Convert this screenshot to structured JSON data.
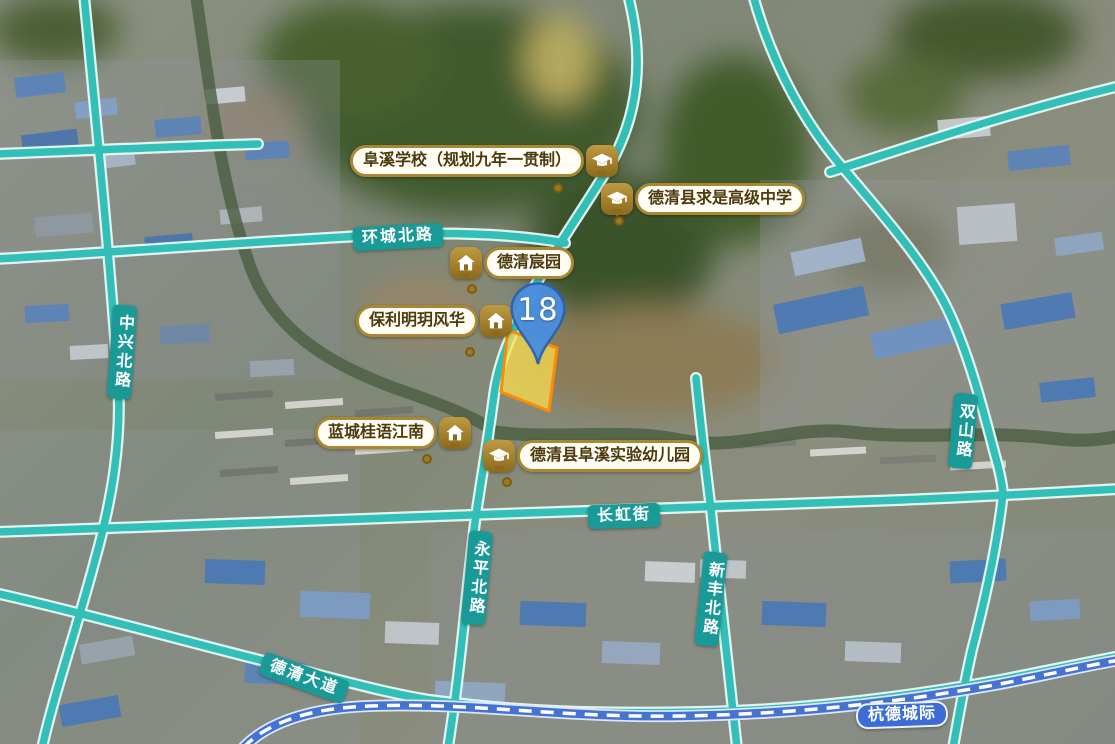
{
  "map": {
    "plot_marker": {
      "number": "18"
    },
    "poi_labels": [
      {
        "id": "fuxi-school",
        "text": "阜溪学校（规划九年一贯制）",
        "icon": "school-icon",
        "icon_side": "right"
      },
      {
        "id": "qiushi-high-school",
        "text": "德清县求是高级中学",
        "icon": "school-icon",
        "icon_side": "left"
      },
      {
        "id": "deqing-chenyuan",
        "text": "德清宸园",
        "icon": "house-icon",
        "icon_side": "left"
      },
      {
        "id": "poly-mingyue",
        "text": "保利明玥风华",
        "icon": "house-icon",
        "icon_side": "right"
      },
      {
        "id": "lancheng-guiyu",
        "text": "蓝城桂语江南",
        "icon": "house-icon",
        "icon_side": "right"
      },
      {
        "id": "fuxi-kindergarten",
        "text": "德清县阜溪实验幼儿园",
        "icon": "school-icon",
        "icon_side": "left"
      }
    ],
    "road_labels": [
      {
        "id": "huancheng-north-rd",
        "text": "环城北路",
        "orientation": "horizontal"
      },
      {
        "id": "zhongxing-north-rd",
        "text": "中兴北路",
        "orientation": "vertical"
      },
      {
        "id": "changhong-street",
        "text": "长虹街",
        "orientation": "horizontal"
      },
      {
        "id": "yongping-north-rd",
        "text": "永平北路",
        "orientation": "vertical"
      },
      {
        "id": "xinfeng-north-rd",
        "text": "新丰北路",
        "orientation": "vertical"
      },
      {
        "id": "shuangshan-rd",
        "text": "双山路",
        "orientation": "vertical"
      },
      {
        "id": "deqing-avenue",
        "text": "德清大道",
        "orientation": "horizontal"
      },
      {
        "id": "hangde-intercity",
        "text": "杭德城际",
        "orientation": "horizontal",
        "type": "railway"
      }
    ],
    "colors": {
      "road": "#31bfb7",
      "road_casing": "#e6faf7",
      "road_label_bg": "#1a9a97",
      "railway": "#4673d2",
      "railway_label_bg": "#3c6dd6",
      "parcel_fill": "#ffe14d",
      "parcel_border": "#ff8b05",
      "pin_fill": "#4a8ede",
      "poi_border": "#aa8732",
      "poi_badge": "#8c6a1b"
    }
  }
}
